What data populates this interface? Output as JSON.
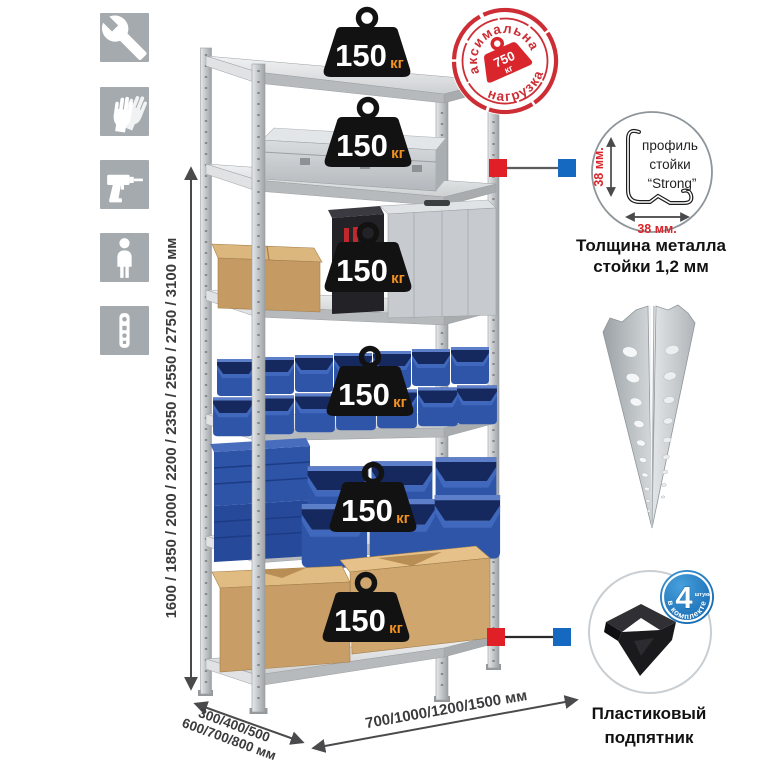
{
  "sidebar": {
    "icons": [
      "wrench-icon",
      "work-gloves-icon",
      "drill-icon",
      "person-icon",
      "perforated-profile-icon"
    ]
  },
  "dimensions": {
    "height": "1600 / 1850 / 2000 / 2200 / 2350 / 2550 / 2750 / 3100 мм",
    "depth_line1": "300/400/500",
    "depth_line2": "600/700/800 мм",
    "width": "700/1000/1200/1500 мм"
  },
  "weights": {
    "value": "150",
    "unit": "кг",
    "count": 6
  },
  "stamp": {
    "text_top": "максимальная",
    "text_bottom": "нагрузка",
    "value": "750",
    "unit": "кг"
  },
  "profile_detail": {
    "label_line1": "профиль",
    "label_line2": "стойки",
    "label_line3": "“Strong”",
    "dim_vertical": "38 мм.",
    "dim_horizontal": "38 мм.",
    "caption_line1": "Толщина металла",
    "caption_line2": "стойки 1,2 мм"
  },
  "foot_detail": {
    "badge_number": "4",
    "badge_side": "штуки",
    "badge_arc": "в комплекте",
    "caption_line1": "Пластиковый",
    "caption_line2": "подпятник"
  },
  "colors": {
    "accent_red": "#d8262c",
    "callout_blue": "#1669c1",
    "bin_blue": "#2e55a8",
    "unit_orange": "#f29222",
    "icon_bg": "#a4aaad"
  }
}
